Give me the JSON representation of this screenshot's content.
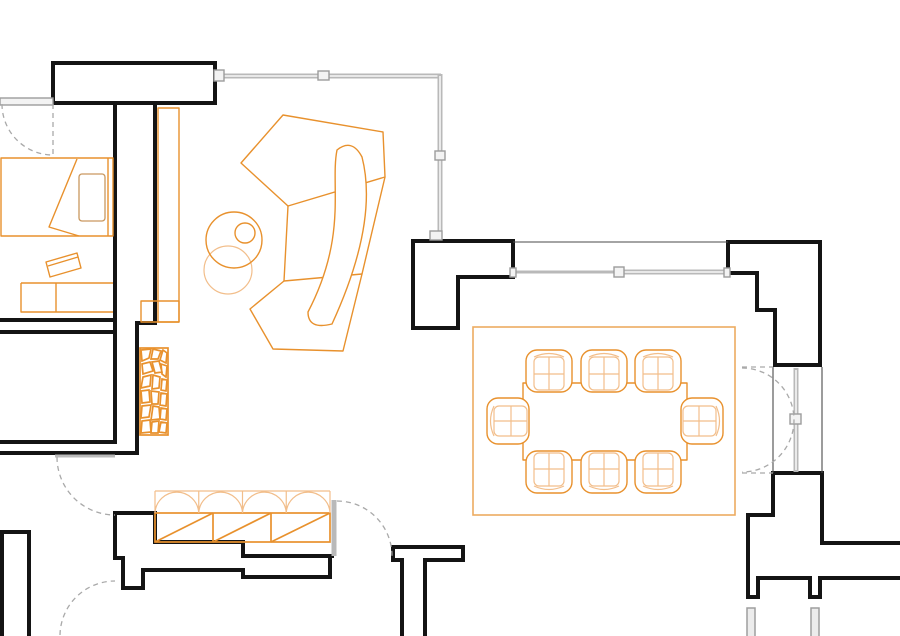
{
  "title": "Apartment floor plan drawing",
  "canvas": {
    "w": 900,
    "h": 636
  },
  "colors": {
    "wall_black": "#141414",
    "glazing_gray": "#b9b9b9",
    "dashed_gray": "#a9a9a9",
    "furniture_orange": "#E8912D",
    "furniture_orange_light": "#F2BE8B",
    "rug_orange": "#EDAB61",
    "pillow_tan": "#C9985F",
    "background": "#ffffff"
  },
  "plan": {
    "elements": [
      {
        "n": "wall-entry-header-bar",
        "e": "path",
        "c": "wallf",
        "a": {
          "d": "M53,63 H215 V103 H53 Z"
        }
      },
      {
        "n": "wall-bedroom-east-inner",
        "e": "path",
        "c": "wall",
        "a": {
          "d": "M115,103 V442"
        }
      },
      {
        "n": "wall-bedroom-east-face",
        "e": "path",
        "c": "wall",
        "a": {
          "d": "M155,103 V323 H137 V453"
        }
      },
      {
        "n": "wall-room-divider-upper",
        "e": "path",
        "c": "wall",
        "a": {
          "d": "M0,320 H115"
        }
      },
      {
        "n": "wall-room-divider-lower",
        "e": "path",
        "c": "wall",
        "a": {
          "d": "M0,332 H115"
        }
      },
      {
        "n": "wall-lowerroom-south-top",
        "e": "path",
        "c": "wall",
        "a": {
          "d": "M0,442 H115"
        }
      },
      {
        "n": "wall-lowerroom-south-bottom",
        "e": "path",
        "c": "wall",
        "a": {
          "d": "M0,453 H137"
        }
      },
      {
        "n": "wall-dining-west",
        "e": "path",
        "c": "wallf",
        "a": {
          "d": "M413,241 H513 V277 H458 V328 H413 Z"
        }
      },
      {
        "n": "wall-dining-east-upper",
        "e": "path",
        "c": "wallf",
        "a": {
          "d": "M728,242 H820 V365 H775 V310 H757 V273 H728 Z"
        }
      },
      {
        "n": "wall-dining-east-lower",
        "e": "path",
        "c": "wallf",
        "a": {
          "d": "M773,473 H822 V543 H902 V578 H820 V597 H810 V578 H758 V597 H748 V515 H773 Z"
        }
      },
      {
        "n": "wall-closet-top-profile",
        "e": "path",
        "c": "wall",
        "a": {
          "d": "M115,513 H155 V542 H243 V556 H332"
        }
      },
      {
        "n": "wall-closet-bottom-profile",
        "e": "path",
        "c": "wall",
        "a": {
          "d": "M115,513 V558 H123 V588 H143 V570 H243 V577 H330 V556"
        }
      },
      {
        "n": "wall-bottom-left-band",
        "e": "path",
        "c": "wall",
        "a": {
          "d": "M2,640 V532 H29 V640"
        }
      },
      {
        "n": "wall-center-pier",
        "e": "path",
        "c": "wall",
        "a": {
          "d": "M393,547 H463 V560 H425 V640 M402,640 V560 H393 V548"
        }
      },
      {
        "n": "line-dining-north-face",
        "e": "path",
        "c": "thin",
        "a": {
          "d": "M513,242 H728"
        }
      },
      {
        "n": "line-door-jamb-west",
        "e": "path",
        "c": "thin",
        "a": {
          "d": "M773,367 V473"
        }
      },
      {
        "n": "line-door-jamb-east",
        "e": "path",
        "c": "thin",
        "a": {
          "d": "M822,367 V473"
        }
      },
      {
        "n": "glazing-north",
        "e": "path",
        "c": "glz",
        "a": {
          "d": "M222,76 H441"
        }
      },
      {
        "n": "glazing-north-core",
        "e": "path",
        "c": "glzc",
        "a": {
          "d": "M224,76 H439"
        }
      },
      {
        "n": "glazing-east",
        "e": "path",
        "c": "glz",
        "a": {
          "d": "M440,74 V236"
        }
      },
      {
        "n": "glazing-east-core",
        "e": "path",
        "c": "glzc",
        "a": {
          "d": "M440,76 V234"
        }
      },
      {
        "n": "glazing-dining-left",
        "e": "path",
        "c": "glz3",
        "a": {
          "d": "M513,272 H618"
        }
      },
      {
        "n": "glazing-dining-right",
        "e": "path",
        "c": "glz",
        "a": {
          "d": "M618,272 H728"
        }
      },
      {
        "n": "glazing-dining-core",
        "e": "path",
        "c": "glzc",
        "a": {
          "d": "M620,272 H726"
        }
      },
      {
        "n": "glazing-door-leaf-right",
        "e": "path",
        "c": "glz",
        "a": {
          "d": "M796,368 V472"
        }
      },
      {
        "n": "glazing-door-leaf-right-core",
        "e": "path",
        "c": "glzc",
        "a": {
          "d": "M796,370 V470"
        }
      },
      {
        "n": "glazing-closet-door-leaf",
        "e": "path",
        "c": "glz",
        "a": {
          "d": "M334,500 V556"
        }
      },
      {
        "n": "window-bedroom",
        "e": "rect",
        "c": "gsq",
        "a": {
          "x": 0,
          "y": 98,
          "width": 53,
          "height": 7
        }
      },
      {
        "n": "lintel-lower-door",
        "e": "path",
        "c": "glz3",
        "a": {
          "d": "M55,456 H115"
        }
      },
      {
        "n": "glazing-connector-northwest",
        "e": "rect",
        "c": "gsq",
        "a": {
          "x": 214,
          "y": 70,
          "width": 10,
          "height": 11
        }
      },
      {
        "n": "glazing-mullion-north",
        "e": "rect",
        "c": "gsq",
        "a": {
          "x": 318,
          "y": 71,
          "width": 11,
          "height": 9
        }
      },
      {
        "n": "glazing-mullion-east",
        "e": "rect",
        "c": "gsq",
        "a": {
          "x": 435,
          "y": 151,
          "width": 10,
          "height": 9
        }
      },
      {
        "n": "glazing-connector-southeast",
        "e": "rect",
        "c": "gsq",
        "a": {
          "x": 430,
          "y": 231,
          "width": 12,
          "height": 9
        }
      },
      {
        "n": "glazing-tick-dining-left",
        "e": "rect",
        "c": "gsq",
        "a": {
          "x": 510,
          "y": 268,
          "width": 6,
          "height": 9
        }
      },
      {
        "n": "glazing-mullion-dining",
        "e": "rect",
        "c": "gsq",
        "a": {
          "x": 614,
          "y": 267,
          "width": 10,
          "height": 10
        }
      },
      {
        "n": "glazing-tick-dining-right",
        "e": "rect",
        "c": "gsq",
        "a": {
          "x": 724,
          "y": 268,
          "width": 6,
          "height": 9
        }
      },
      {
        "n": "door-handle-right",
        "e": "rect",
        "c": "gsq",
        "a": {
          "x": 790,
          "y": 414,
          "width": 11,
          "height": 10
        }
      },
      {
        "n": "column-bar-bottom-left",
        "e": "rect",
        "c": "gbar",
        "a": {
          "x": 747,
          "y": 608,
          "width": 8,
          "height": 34
        }
      },
      {
        "n": "column-bar-bottom-right",
        "e": "rect",
        "c": "gbar",
        "a": {
          "x": 811,
          "y": 608,
          "width": 8,
          "height": 34
        }
      },
      {
        "n": "bed-frame",
        "e": "path",
        "c": "org",
        "a": {
          "d": "M1,158 H113 V236 H1 Z"
        }
      },
      {
        "n": "bed-headboard-line",
        "e": "path",
        "c": "org",
        "a": {
          "d": "M108,158 V236"
        }
      },
      {
        "n": "bed-pillow",
        "e": "rect",
        "c": "pil",
        "a": {
          "x": 79,
          "y": 174,
          "width": 26,
          "height": 47,
          "rx": 3
        }
      },
      {
        "n": "bed-blanket-fold",
        "e": "path",
        "c": "org",
        "a": {
          "d": "M77,159 L49,227 L79,236"
        }
      },
      {
        "n": "desk",
        "e": "path",
        "c": "org",
        "a": {
          "d": "M21,283 H113 M21,283 V312 H113 M56,283 V312"
        }
      },
      {
        "n": "desk-paper",
        "e": "path",
        "c": "org",
        "a": {
          "d": "M46,262 L77,253 L81,268 L50,277 Z M48,266 L78,257"
        }
      },
      {
        "n": "console-band",
        "e": "rect",
        "c": "org",
        "a": {
          "x": 158,
          "y": 108,
          "width": 21,
          "height": 214
        }
      },
      {
        "n": "console-base",
        "e": "rect",
        "c": "org",
        "a": {
          "x": 141,
          "y": 301,
          "width": 38,
          "height": 21
        }
      },
      {
        "n": "stool-circle",
        "e": "circle",
        "c": "orgl",
        "a": {
          "cx": 228,
          "cy": 270,
          "r": 24
        }
      },
      {
        "n": "side-table-circle",
        "e": "circle",
        "c": "org",
        "a": {
          "cx": 234,
          "cy": 240,
          "r": 28
        }
      },
      {
        "n": "plant-circle",
        "e": "circle",
        "c": "org",
        "a": {
          "cx": 245,
          "cy": 233,
          "r": 10
        }
      },
      {
        "n": "sofa-back-section",
        "e": "path",
        "c": "org",
        "a": {
          "d": "M283,115 L383,132 L385,177 L288,206 L241,163 Z"
        }
      },
      {
        "n": "sofa-mid-section",
        "e": "path",
        "c": "org",
        "a": {
          "d": "M385,177 L362,274 M288,206 L284,281"
        }
      },
      {
        "n": "sofa-front-section",
        "e": "path",
        "c": "org",
        "a": {
          "d": "M284,281 L250,309 L273,349 L343,351 L362,274 Z"
        }
      },
      {
        "n": "sofa-chaise",
        "e": "path",
        "c": "whitef",
        "a": {
          "d": "M337,150 C330,185 348,235 308,312 Q308,330 332,324 C366,250 372,196 362,157 Q352,138 337,150 Z"
        }
      },
      {
        "n": "fireplace-frame",
        "e": "rect",
        "c": "orgb",
        "a": {
          "x": 140,
          "y": 348,
          "width": 28,
          "height": 87
        }
      },
      {
        "n": "fireplace-mosaic-cells",
        "e": "path",
        "c": "orgb",
        "a": {
          "d": "M141,350 L151,349 L149,358 L142,361 Z M153,349 L161,351 L158,359 L151,359 Z M163,350 L167,353 L166,363 L160,360 Z M142,364 L150,362 L153,371 L143,374 Z M152,362 L159,361 L162,372 L155,373 Z M161,364 L167,366 L166,377 L162,374 Z M143,377 L151,375 L150,386 L141,388 Z M153,375 L160,377 L159,388 L152,389 Z M162,379 L167,380 L166,391 L161,390 Z M141,391 L149,390 L150,402 L142,403 Z M151,391 L159,392 L158,404 L152,404 Z M161,393 L167,394 L166,406 L160,405 Z M142,406 L151,405 L149,417 L141,418 Z M153,406 L159,407 L160,419 L151,420 Z M161,408 L167,409 L166,420 L160,419 Z M142,421 L150,420 L151,432 L141,433 Z M152,422 L159,421 L158,433 L151,433 Z M161,422 L167,423 L166,433 L159,432 Z"
        }
      },
      {
        "n": "closet-bays",
        "e": "rect",
        "c": "orgb",
        "a": {
          "x": 155,
          "y": 513,
          "width": 175,
          "height": 29
        }
      },
      {
        "n": "closet-bay-dividers",
        "e": "path",
        "c": "orgb",
        "a": {
          "d": "M213,513 V542 M271,513 V542"
        }
      },
      {
        "n": "closet-bay-diagonals",
        "e": "path",
        "c": "orgb",
        "a": {
          "d": "M155,542 L213,513 M213,542 L271,513 M271,542 L330,513"
        }
      },
      {
        "n": "closet-door-arcs",
        "e": "path",
        "c": "orgl",
        "a": {
          "d": "M155,491 H330 M155,491 V513 M198.75,491 V513 M242.5,491 V513 M286.25,491 V513 M330,491 V513 M155,513 A21.9,21.9 0 0 1 198.75,513 M198.75,513 A21.9,21.9 0 0 1 242.5,513 M242.5,513 A21.9,21.9 0 0 1 286.25,513 M286.25,513 A21.9,21.9 0 0 1 330,513"
        }
      },
      {
        "n": "dining-rug",
        "e": "rect",
        "c": "rug",
        "a": {
          "x": 473,
          "y": 327,
          "width": 262,
          "height": 188
        }
      },
      {
        "n": "dining-table",
        "e": "rect",
        "c": "org",
        "a": {
          "x": 523,
          "y": 383,
          "width": 164,
          "height": 77
        }
      },
      {
        "n": "door-bedroom-leaf",
        "e": "path",
        "c": "dash",
        "a": {
          "d": "M53,104 V156"
        }
      },
      {
        "n": "door-bedroom-arc",
        "e": "path",
        "c": "dash",
        "a": {
          "d": "M2,104 A51,51 0 0 0 53,155"
        }
      },
      {
        "n": "door-lowerroom-arc",
        "e": "path",
        "c": "dash",
        "a": {
          "d": "M57,457 A58,58 0 0 0 115,515"
        }
      },
      {
        "n": "door-bottomleft-arc",
        "e": "path",
        "c": "dash",
        "a": {
          "d": "M60,635 A55,55 0 0 1 115,581"
        }
      },
      {
        "n": "door-closet-arc",
        "e": "path",
        "c": "dash",
        "a": {
          "d": "M337,501 A55,55 0 0 1 392,556"
        }
      },
      {
        "n": "door-double-top-leaf",
        "e": "path",
        "c": "dash",
        "a": {
          "d": "M742,367 H773"
        }
      },
      {
        "n": "door-double-top-arc",
        "e": "path",
        "c": "dash",
        "a": {
          "d": "M742,368 A52,52 0 0 1 794,420"
        }
      },
      {
        "n": "door-double-bottom-leaf",
        "e": "path",
        "c": "dash",
        "a": {
          "d": "M742,473 H773"
        }
      },
      {
        "n": "door-double-bottom-arc",
        "e": "path",
        "c": "dash",
        "a": {
          "d": "M794,420 A52,52 0 0 1 742,472"
        }
      }
    ],
    "dining": {
      "chairs": [
        {
          "cx": 549,
          "cy": 371,
          "rot": 0
        },
        {
          "cx": 604,
          "cy": 371,
          "rot": 0
        },
        {
          "cx": 658,
          "cy": 371,
          "rot": 0
        },
        {
          "cx": 549,
          "cy": 472,
          "rot": 180
        },
        {
          "cx": 604,
          "cy": 472,
          "rot": 180
        },
        {
          "cx": 658,
          "cy": 472,
          "rot": 180
        },
        {
          "cx": 508,
          "cy": 421,
          "rot": 270
        },
        {
          "cx": 702,
          "cy": 421,
          "rot": 90
        }
      ],
      "chair_glyph": {
        "outer": {
          "x": -23,
          "y": -21,
          "w": 46,
          "h": 42,
          "rx": 11
        },
        "seat": {
          "x": -15,
          "y": -14,
          "w": 30,
          "h": 33,
          "rx": 5
        },
        "center_line": [
          0,
          -14,
          0,
          19
        ],
        "mid_line": [
          -15,
          3,
          15,
          3
        ],
        "back_curve": "M-15,-14 Q0,-21 15,-14"
      }
    }
  }
}
